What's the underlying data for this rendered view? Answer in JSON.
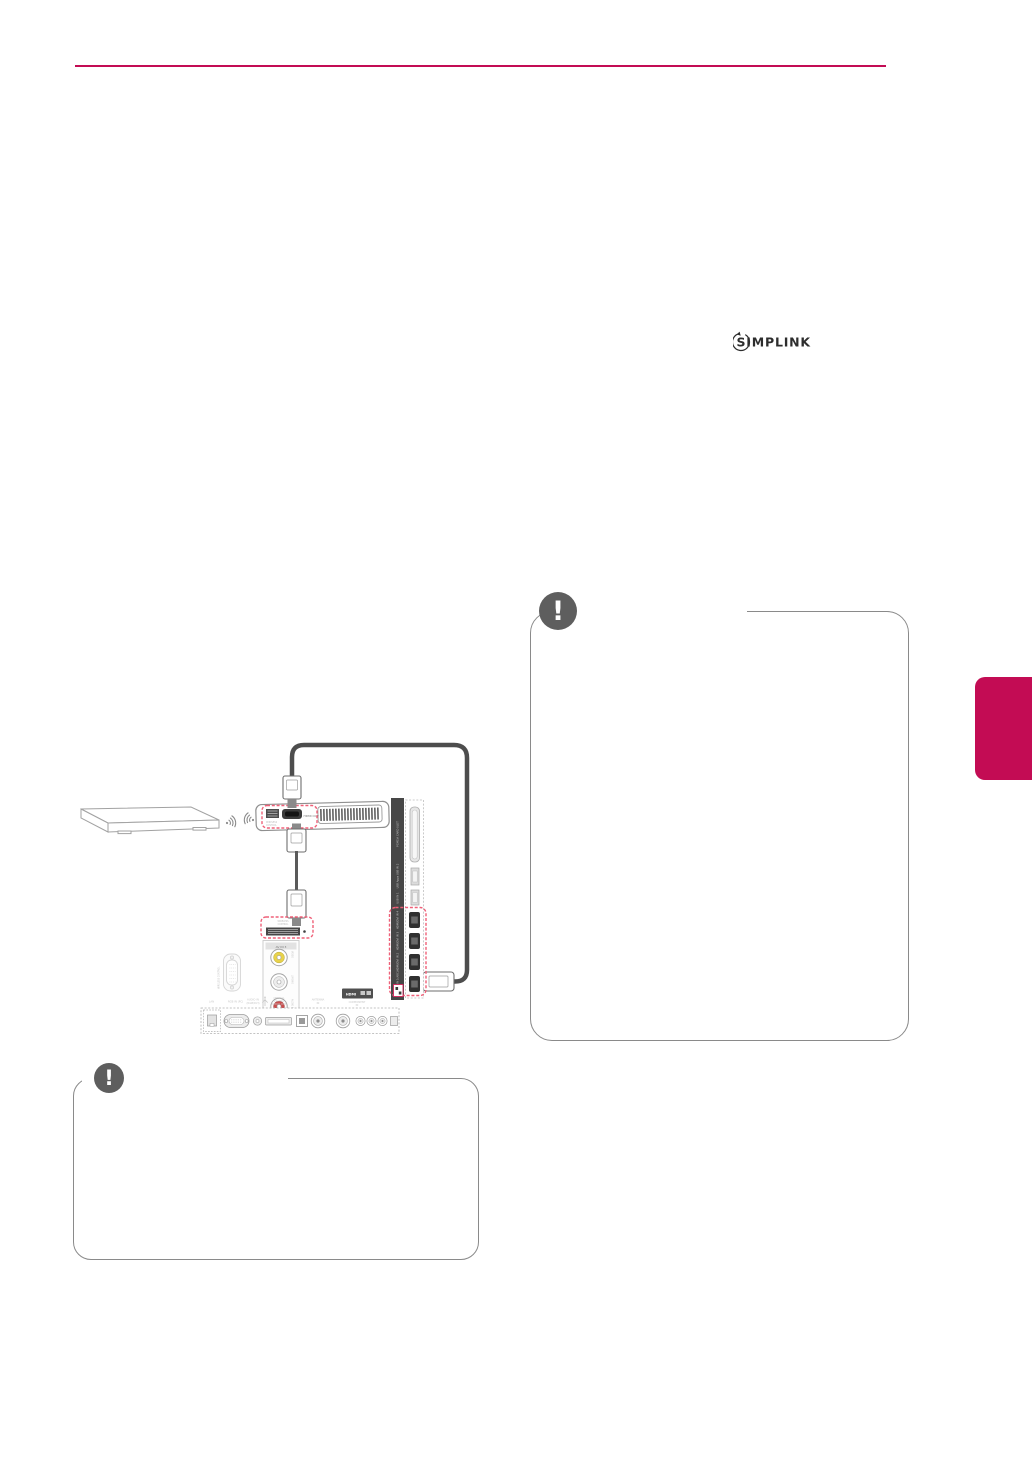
{
  "page": {
    "accent_color": "#c30c54",
    "red_dash_color": "#ef6078",
    "note_border_color": "#8a8a8a"
  },
  "logo": {
    "text": "SIMPLINK"
  },
  "notes": {
    "icon_glyph": "!"
  },
  "diagram": {
    "wireless_box": {
      "control_label_1": "WIRELESS",
      "control_label_2": "CONTROL",
      "hdmi_out_label": "HDMI OUT"
    },
    "tv_wireless_control": {
      "label_1": "WIRELESS",
      "label_2": "CONTROL"
    },
    "av_strip": {
      "header": "AV IN 3",
      "jack_labels": [
        "VIDEO",
        "L/MONO",
        "AUDIO R"
      ]
    },
    "dsub_label": "WIRELESS CONTROL",
    "side_panel": {
      "pcmcia_label": "PCMCIA CARD SLOT",
      "usb2_label": "USB Apps USB IN 2",
      "usb1_label": "USB IN 1",
      "hdmi_labels": [
        "HDMI/DVI IN 4",
        "HDMI/DVI IN 3",
        "HDMI/DVI IN 2",
        "HDMI/DVI IN 1(ARC)"
      ]
    },
    "bottom_panel": {
      "lan_label": "LAN",
      "rgb_label": "RGB IN (PC)",
      "audio_label_1": "AUDIO IN",
      "audio_label_2": "(RGB/DVI)",
      "optical_label_1": "OPTICAL",
      "optical_label_2": "DIGITAL",
      "optical_label_3": "AUDIO OUT",
      "antenna_label_1": "ANTENNA",
      "antenna_label_2": "IN",
      "component_label_1": "COMPONENT",
      "component_label_2": "IN",
      "hdmi_badge": "HDMI"
    }
  }
}
